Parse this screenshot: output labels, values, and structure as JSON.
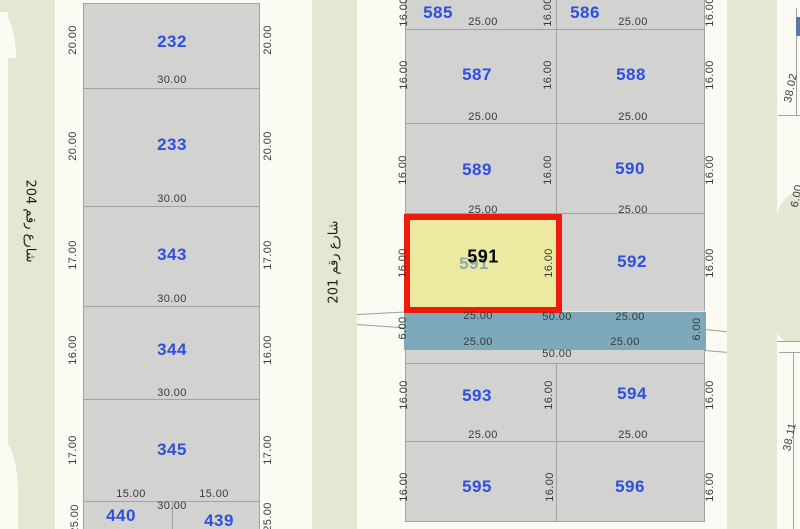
{
  "app": {
    "description": "Cadastral parcel map with selected parcel 591"
  },
  "colors": {
    "background": "#fbfaf3",
    "parcel_fill": "#d2d2d0",
    "parcel_border": "#a2a2a0",
    "street_fill": "#e5e7d2",
    "road_strip": "#7ea9ba",
    "highlight_fill": "#ece9a0",
    "highlight_border": "#ee1b0c",
    "parcel_number": "#2e4fe0",
    "dimension_text": "#3a3a38",
    "top_right_bar": "#527ea3"
  },
  "selected_parcel": {
    "number": "591"
  },
  "labels": [
    {
      "name": "street-label-204",
      "text": "شارع رقم 204",
      "x": 30,
      "y": 221,
      "rot": 90,
      "cls": "street"
    },
    {
      "name": "street-label-201",
      "text": "شارع رقم 201",
      "x": 334,
      "y": 262,
      "rot": -90,
      "cls": "street"
    },
    {
      "name": "parcel-number-232",
      "text": "232",
      "x": 172,
      "y": 42,
      "cls": "pnum"
    },
    {
      "name": "parcel-number-233",
      "text": "233",
      "x": 172,
      "y": 145,
      "cls": "pnum"
    },
    {
      "name": "parcel-number-343",
      "text": "343",
      "x": 172,
      "y": 255,
      "cls": "pnum"
    },
    {
      "name": "parcel-number-344",
      "text": "344",
      "x": 172,
      "y": 350,
      "cls": "pnum"
    },
    {
      "name": "parcel-number-345",
      "text": "345",
      "x": 172,
      "y": 450,
      "cls": "pnum"
    },
    {
      "name": "parcel-number-440",
      "text": "440",
      "x": 121,
      "y": 516,
      "cls": "pnum"
    },
    {
      "name": "parcel-number-439",
      "text": "439",
      "x": 219,
      "y": 521,
      "cls": "pnum"
    },
    {
      "name": "parcel-number-585",
      "text": "585",
      "x": 438,
      "y": 13,
      "cls": "pnum"
    },
    {
      "name": "parcel-number-586",
      "text": "586",
      "x": 585,
      "y": 13,
      "cls": "pnum"
    },
    {
      "name": "parcel-number-587",
      "text": "587",
      "x": 477,
      "y": 75,
      "cls": "pnum"
    },
    {
      "name": "parcel-number-588",
      "text": "588",
      "x": 631,
      "y": 75,
      "cls": "pnum"
    },
    {
      "name": "parcel-number-589",
      "text": "589",
      "x": 477,
      "y": 170,
      "cls": "pnum"
    },
    {
      "name": "parcel-number-590",
      "text": "590",
      "x": 630,
      "y": 169,
      "cls": "pnum"
    },
    {
      "name": "parcel-number-591-ghost",
      "text": "591",
      "x": 474,
      "y": 264,
      "cls": "pnum ghost"
    },
    {
      "name": "parcel-number-591-selected",
      "text": "591",
      "x": 483,
      "y": 257,
      "cls": "sel"
    },
    {
      "name": "parcel-number-592",
      "text": "592",
      "x": 632,
      "y": 262,
      "cls": "pnum"
    },
    {
      "name": "parcel-number-593",
      "text": "593",
      "x": 477,
      "y": 396,
      "cls": "pnum"
    },
    {
      "name": "parcel-number-594",
      "text": "594",
      "x": 632,
      "y": 394,
      "cls": "pnum"
    },
    {
      "name": "parcel-number-595",
      "text": "595",
      "x": 477,
      "y": 487,
      "cls": "pnum"
    },
    {
      "name": "parcel-number-596",
      "text": "596",
      "x": 630,
      "y": 487,
      "cls": "pnum"
    },
    {
      "name": "dim-232-bottom",
      "text": "30.00",
      "x": 172,
      "y": 80
    },
    {
      "name": "dim-233-bottom",
      "text": "30.00",
      "x": 172,
      "y": 199
    },
    {
      "name": "dim-343-bottom",
      "text": "30.00",
      "x": 172,
      "y": 299
    },
    {
      "name": "dim-344-bottom",
      "text": "30.00",
      "x": 172,
      "y": 393
    },
    {
      "name": "dim-345-bottom-left",
      "text": "15.00",
      "x": 131,
      "y": 494
    },
    {
      "name": "dim-345-bottom-right",
      "text": "15.00",
      "x": 214,
      "y": 494
    },
    {
      "name": "dim-440-439-top",
      "text": "30.00",
      "x": 172,
      "y": 506
    },
    {
      "name": "dim-585-bottom",
      "text": "25.00",
      "x": 483,
      "y": 22
    },
    {
      "name": "dim-586-bottom",
      "text": "25.00",
      "x": 633,
      "y": 22
    },
    {
      "name": "dim-587-bottom",
      "text": "25.00",
      "x": 483,
      "y": 117
    },
    {
      "name": "dim-588-bottom",
      "text": "25.00",
      "x": 633,
      "y": 117
    },
    {
      "name": "dim-589-bottom",
      "text": "25.00",
      "x": 483,
      "y": 210
    },
    {
      "name": "dim-590-bottom",
      "text": "25.00",
      "x": 633,
      "y": 210
    },
    {
      "name": "dim-road-top-left",
      "text": "25.00",
      "x": 478,
      "y": 316
    },
    {
      "name": "dim-road-top-center",
      "text": "50.00",
      "x": 557,
      "y": 317
    },
    {
      "name": "dim-road-top-right",
      "text": "25.00",
      "x": 630,
      "y": 317
    },
    {
      "name": "dim-road-bottom-left",
      "text": "25.00",
      "x": 478,
      "y": 342
    },
    {
      "name": "dim-road-bottom-right",
      "text": "25.00",
      "x": 625,
      "y": 342
    },
    {
      "name": "dim-road-bottom-center",
      "text": "50.00",
      "x": 557,
      "y": 354
    },
    {
      "name": "dim-593-bottom",
      "text": "25.00",
      "x": 483,
      "y": 435
    },
    {
      "name": "dim-594-bottom",
      "text": "25.00",
      "x": 633,
      "y": 435
    },
    {
      "name": "dim-232-left",
      "text": "20.00",
      "x": 73,
      "y": 40,
      "rot": -90
    },
    {
      "name": "dim-232-right",
      "text": "20.00",
      "x": 268,
      "y": 40,
      "rot": -90
    },
    {
      "name": "dim-233-left",
      "text": "20.00",
      "x": 73,
      "y": 146,
      "rot": -90
    },
    {
      "name": "dim-233-right",
      "text": "20.00",
      "x": 268,
      "y": 146,
      "rot": -90
    },
    {
      "name": "dim-343-left",
      "text": "17.00",
      "x": 73,
      "y": 255,
      "rot": -90
    },
    {
      "name": "dim-343-right",
      "text": "17.00",
      "x": 268,
      "y": 255,
      "rot": -90
    },
    {
      "name": "dim-344-left",
      "text": "16.00",
      "x": 73,
      "y": 350,
      "rot": -90
    },
    {
      "name": "dim-344-right",
      "text": "16.00",
      "x": 268,
      "y": 350,
      "rot": -90
    },
    {
      "name": "dim-345-left",
      "text": "17.00",
      "x": 73,
      "y": 450,
      "rot": -90
    },
    {
      "name": "dim-345-right",
      "text": "17.00",
      "x": 268,
      "y": 450,
      "rot": -90
    },
    {
      "name": "dim-440-left",
      "text": "25.00",
      "x": 75,
      "y": 519,
      "rot": -90
    },
    {
      "name": "dim-439-right",
      "text": "25.00",
      "x": 268,
      "y": 517,
      "rot": -90
    },
    {
      "name": "dim-585-left",
      "text": "16.00",
      "x": 404,
      "y": 12,
      "rot": -90
    },
    {
      "name": "dim-585-right",
      "text": "16.00",
      "x": 548,
      "y": 12,
      "rot": -90
    },
    {
      "name": "dim-586-right",
      "text": "16.00",
      "x": 710,
      "y": 12,
      "rot": -90
    },
    {
      "name": "dim-587-left",
      "text": "16.00",
      "x": 404,
      "y": 75,
      "rot": -90
    },
    {
      "name": "dim-587-right",
      "text": "16.00",
      "x": 548,
      "y": 75,
      "rot": -90
    },
    {
      "name": "dim-588-right",
      "text": "16.00",
      "x": 710,
      "y": 75,
      "rot": -90
    },
    {
      "name": "dim-589-left",
      "text": "16.00",
      "x": 403,
      "y": 170,
      "rot": -90
    },
    {
      "name": "dim-589-right",
      "text": "16.00",
      "x": 548,
      "y": 170,
      "rot": -90
    },
    {
      "name": "dim-590-right",
      "text": "16.00",
      "x": 710,
      "y": 170,
      "rot": -90
    },
    {
      "name": "dim-591-left",
      "text": "16.00",
      "x": 403,
      "y": 263,
      "rot": -90
    },
    {
      "name": "dim-591-right",
      "text": "16.00",
      "x": 549,
      "y": 263,
      "rot": -90
    },
    {
      "name": "dim-592-right",
      "text": "16.00",
      "x": 710,
      "y": 263,
      "rot": -90
    },
    {
      "name": "dim-593-left",
      "text": "16.00",
      "x": 404,
      "y": 395,
      "rot": -90
    },
    {
      "name": "dim-593-right",
      "text": "16.00",
      "x": 549,
      "y": 395,
      "rot": -90
    },
    {
      "name": "dim-594-right",
      "text": "16.00",
      "x": 710,
      "y": 395,
      "rot": -90
    },
    {
      "name": "dim-595-left",
      "text": "16.00",
      "x": 404,
      "y": 487,
      "rot": -90
    },
    {
      "name": "dim-595-right",
      "text": "16.00",
      "x": 550,
      "y": 487,
      "rot": -90
    },
    {
      "name": "dim-596-right",
      "text": "16.00",
      "x": 710,
      "y": 487,
      "rot": -90
    },
    {
      "name": "dim-road-left",
      "text": "6.00",
      "x": 403,
      "y": 328,
      "rot": -90
    },
    {
      "name": "dim-road-right",
      "text": "6.00",
      "x": 697,
      "y": 329,
      "rot": -90
    },
    {
      "name": "dim-right-block-upper",
      "text": "38.02",
      "x": 791,
      "y": 88,
      "rot": -78
    },
    {
      "name": "dim-right-block-lower",
      "text": "38.11",
      "x": 790,
      "y": 437,
      "rot": -78
    },
    {
      "name": "dim-right-road",
      "text": "6.00",
      "x": 797,
      "y": 196,
      "rot": -78
    }
  ]
}
